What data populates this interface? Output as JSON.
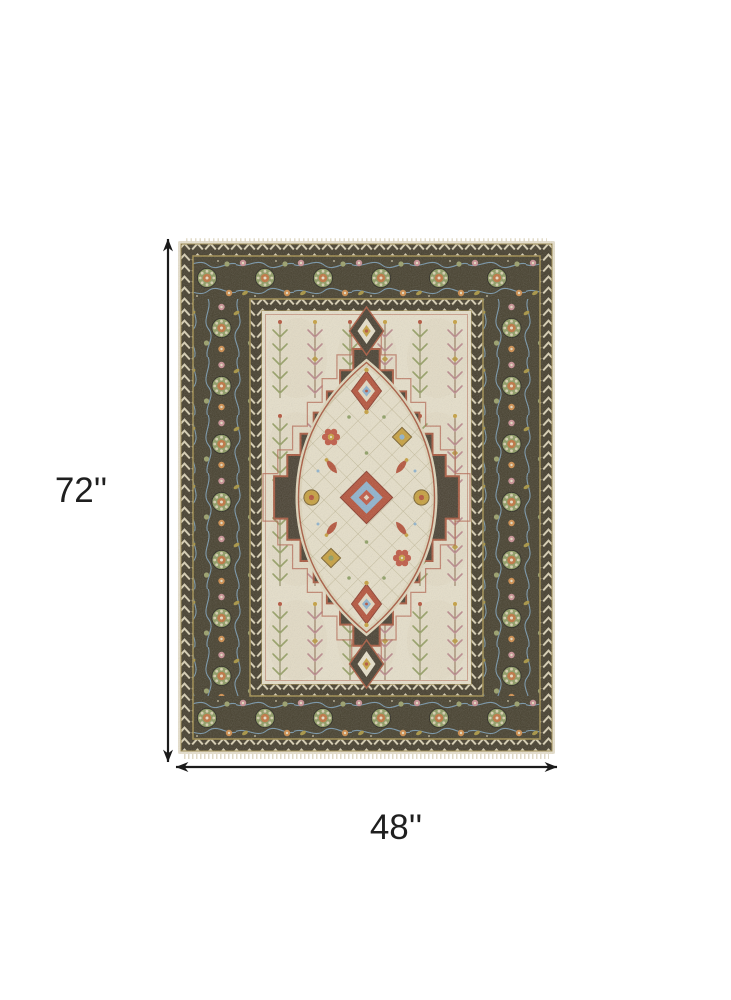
{
  "figure": {
    "type": "product-dimension-diagram",
    "subject": "Traditional medallion area rug shown flat, top view",
    "height": {
      "label": "72''",
      "value": 72,
      "unit": "in"
    },
    "width": {
      "label": "48''",
      "value": 48,
      "unit": "in"
    }
  },
  "colors": {
    "canvas_background": "#ffffff",
    "dimension_lines": "#1b1b1b",
    "label_text": "#1f1f1f",
    "rug_selvage": "#e7e0cd",
    "rug_border": "#46402e",
    "rug_guard_gold": "#9c894c",
    "rug_field": "#e6dfca",
    "rug_medallion": "#4a4233",
    "accent_rust": "#b5543c",
    "accent_gold": "#c6a03f",
    "accent_sage": "#8e9c63",
    "accent_blue": "#8fb3cd",
    "accent_pink": "#c98f93"
  }
}
